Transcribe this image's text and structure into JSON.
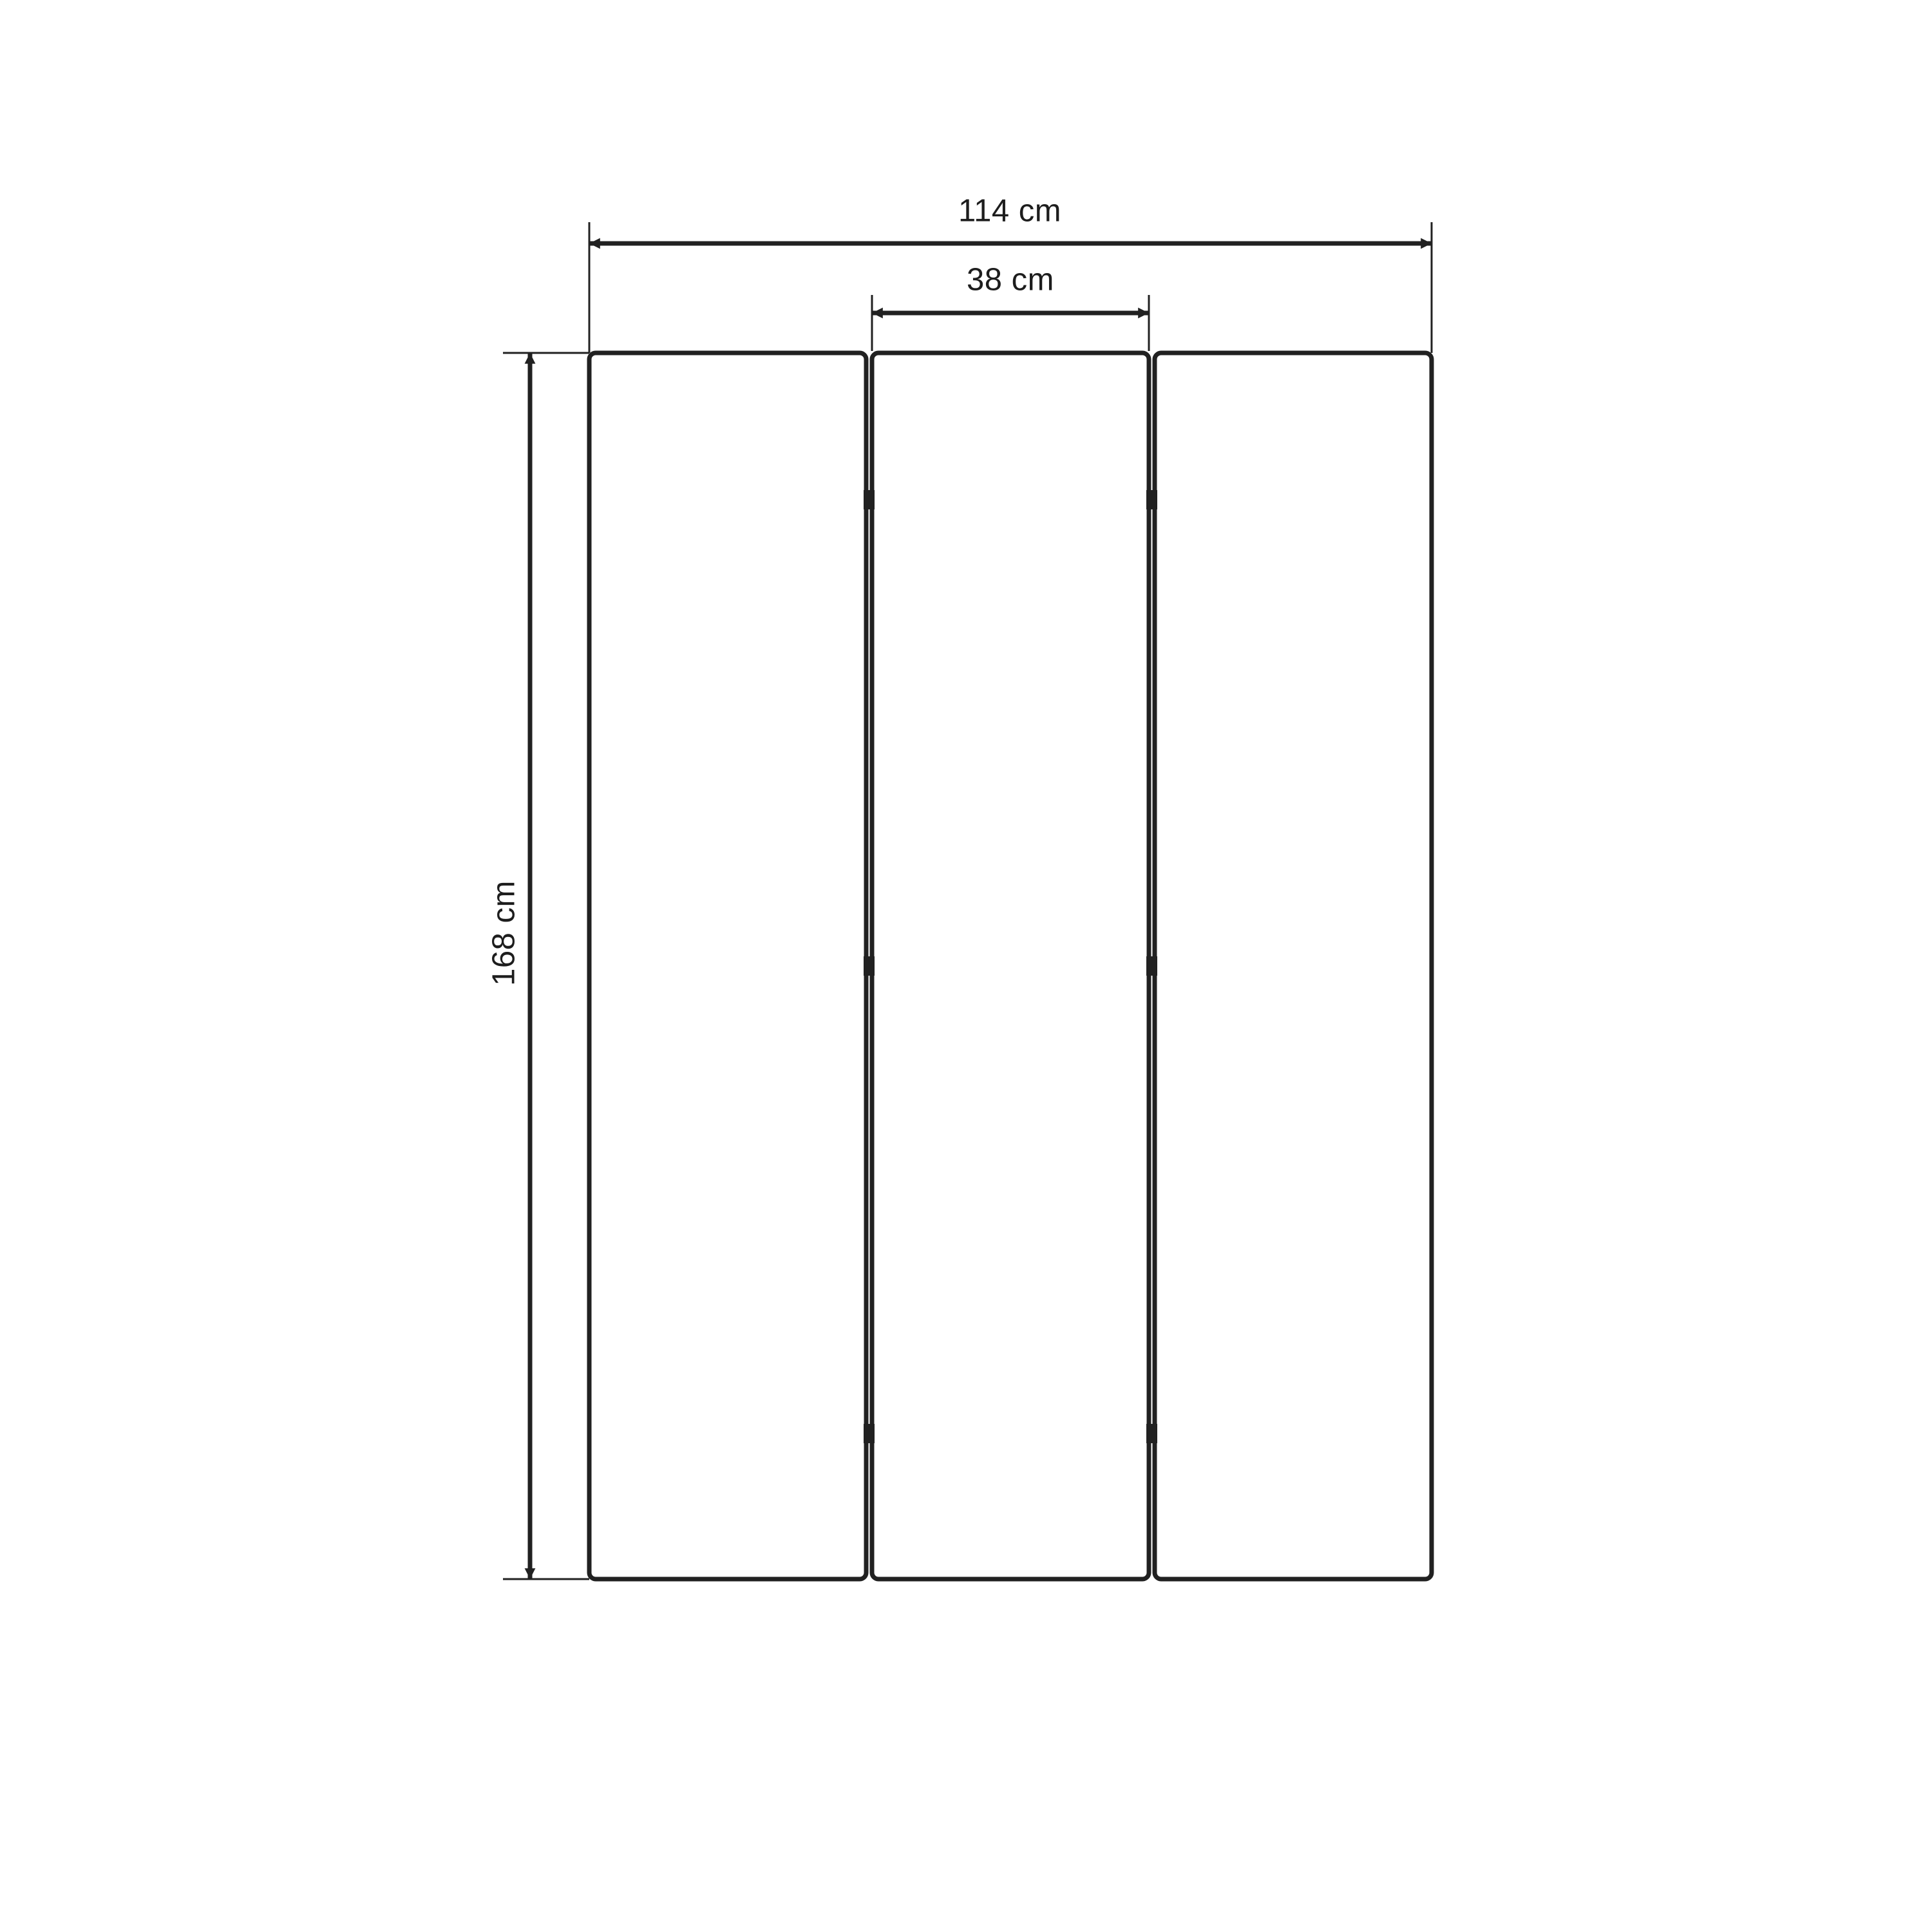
{
  "diagram": {
    "background": "#ffffff",
    "line_color": "#212121",
    "text_color": "#1d1d1d",
    "panel_count": 3,
    "hinge_rows": 3,
    "dimensions": {
      "total_width": "114 cm",
      "panel_width": "38 cm",
      "height": "168 cm"
    }
  }
}
